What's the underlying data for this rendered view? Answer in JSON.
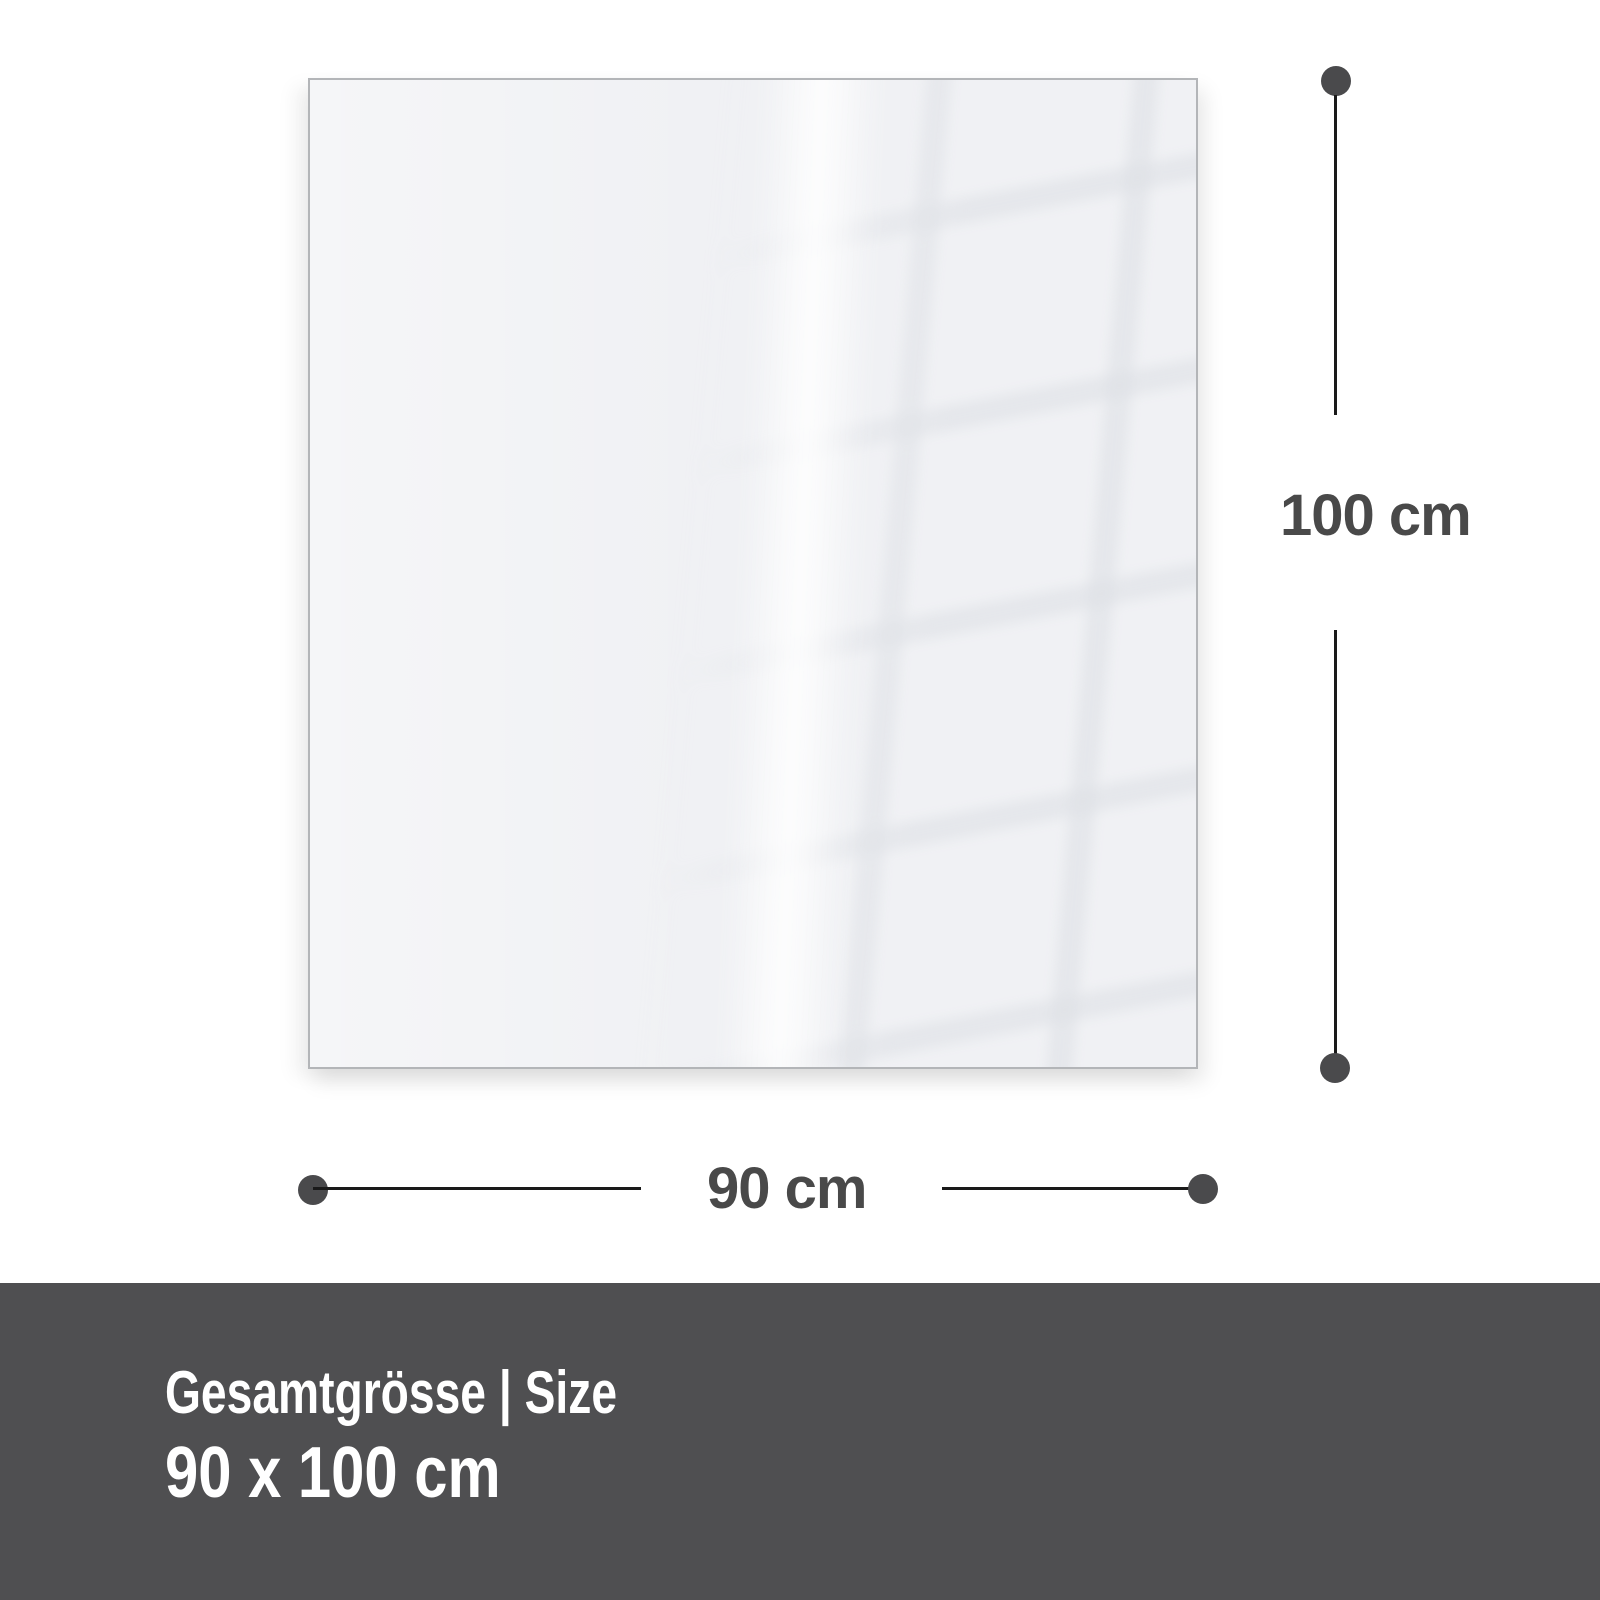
{
  "dimension_annotations": {
    "vertical": {
      "label": "100 cm"
    },
    "horizontal": {
      "label": "90 cm"
    }
  },
  "footer": {
    "title": "Gesamtgrösse | Size",
    "size_value": "90 x 100 cm"
  },
  "colors": {
    "background": "#ffffff",
    "panel_fill": "#f0f1f4",
    "panel_border": "#b3b5b8",
    "grid_reflection_line": "#cdd1d8",
    "dimension_line": "#1a1a1a",
    "dimension_dot": "#4a4a4c",
    "dimension_text": "#494949",
    "footer_background": "#4f4f51",
    "footer_text": "#ffffff"
  }
}
